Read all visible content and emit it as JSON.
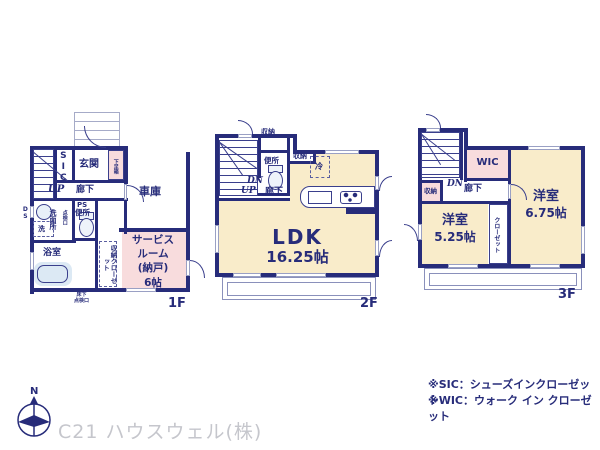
{
  "f1": {
    "floor_label": "1F",
    "sic": "SIC",
    "genkan": "玄関",
    "getabako": "下足箱",
    "up": "UP",
    "rouka": "廊下",
    "garage": "車庫",
    "ds": "DS",
    "senmenjo": "洗面所",
    "tenken_small": "点検口",
    "washer": "洗",
    "ps": "PS",
    "benjo": "便所",
    "yokushitsu": "浴室",
    "shuno_closet": "収納クローゼット",
    "service_room": "サービス\nルーム\n(納戸)\n6帖",
    "yukashita_tenken": "床下\n点検口"
  },
  "f2": {
    "floor_label": "2F",
    "shuno_top": "収納",
    "shuno_right": "収納",
    "benjo": "便所",
    "dn": "DN",
    "up": "UP",
    "rouka": "廊下",
    "fridge": "冷",
    "ldk": "LDK",
    "ldk_size": "16.25帖"
  },
  "f3": {
    "floor_label": "3F",
    "wic": "WIC",
    "shuno": "収納",
    "dn": "DN",
    "rouka": "廊下",
    "room1": "洋室",
    "room1_size": "6.75帖",
    "room2": "洋室",
    "room2_size": "5.25帖",
    "closet": "クローゼット"
  },
  "notes": {
    "sic": "※SIC：シューズインクローゼット",
    "wic": "※WIC：ウォーク イン クローゼット"
  },
  "footer": {
    "company": "C21 ハウスウェル(株)",
    "north": "N"
  },
  "colors": {
    "wall": "#272c7a",
    "room_pink": "#f8dcdd",
    "room_cream": "#f9ecca",
    "fixture_blue": "#dce9f4",
    "footer_gray": "#c5c6cc"
  }
}
